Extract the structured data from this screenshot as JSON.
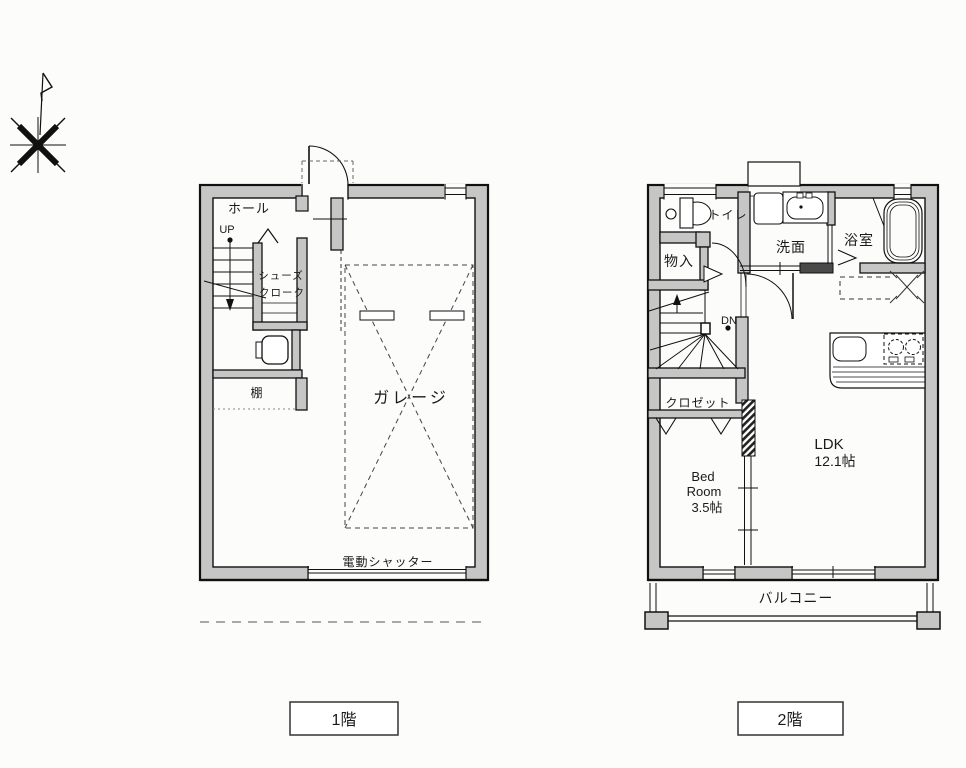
{
  "colors": {
    "wall": "#c6c6c6",
    "wall_dark": "#4a4a4a",
    "line": "#1a1a1a",
    "bg": "#fcfcfa"
  },
  "floor1": {
    "caption": "1階",
    "hall": "ホール",
    "up_label": "UP",
    "shoe_closet_line1": "シューズ",
    "shoe_closet_line2": "クローク",
    "shelf": "棚",
    "garage": "ガレージ",
    "shutter": "電動シャッター"
  },
  "floor2": {
    "caption": "2階",
    "toilet": "トイレ",
    "storage": "物入",
    "washroom": "洗面",
    "bathroom": "浴室",
    "down_label": "DN",
    "closet": "クロゼット",
    "bedroom_line1": "Bed",
    "bedroom_line2": "Room",
    "bedroom_line3": "3.5帖",
    "ldk_line1": "LDK",
    "ldk_line2": "12.1帖",
    "balcony": "バルコニー"
  }
}
